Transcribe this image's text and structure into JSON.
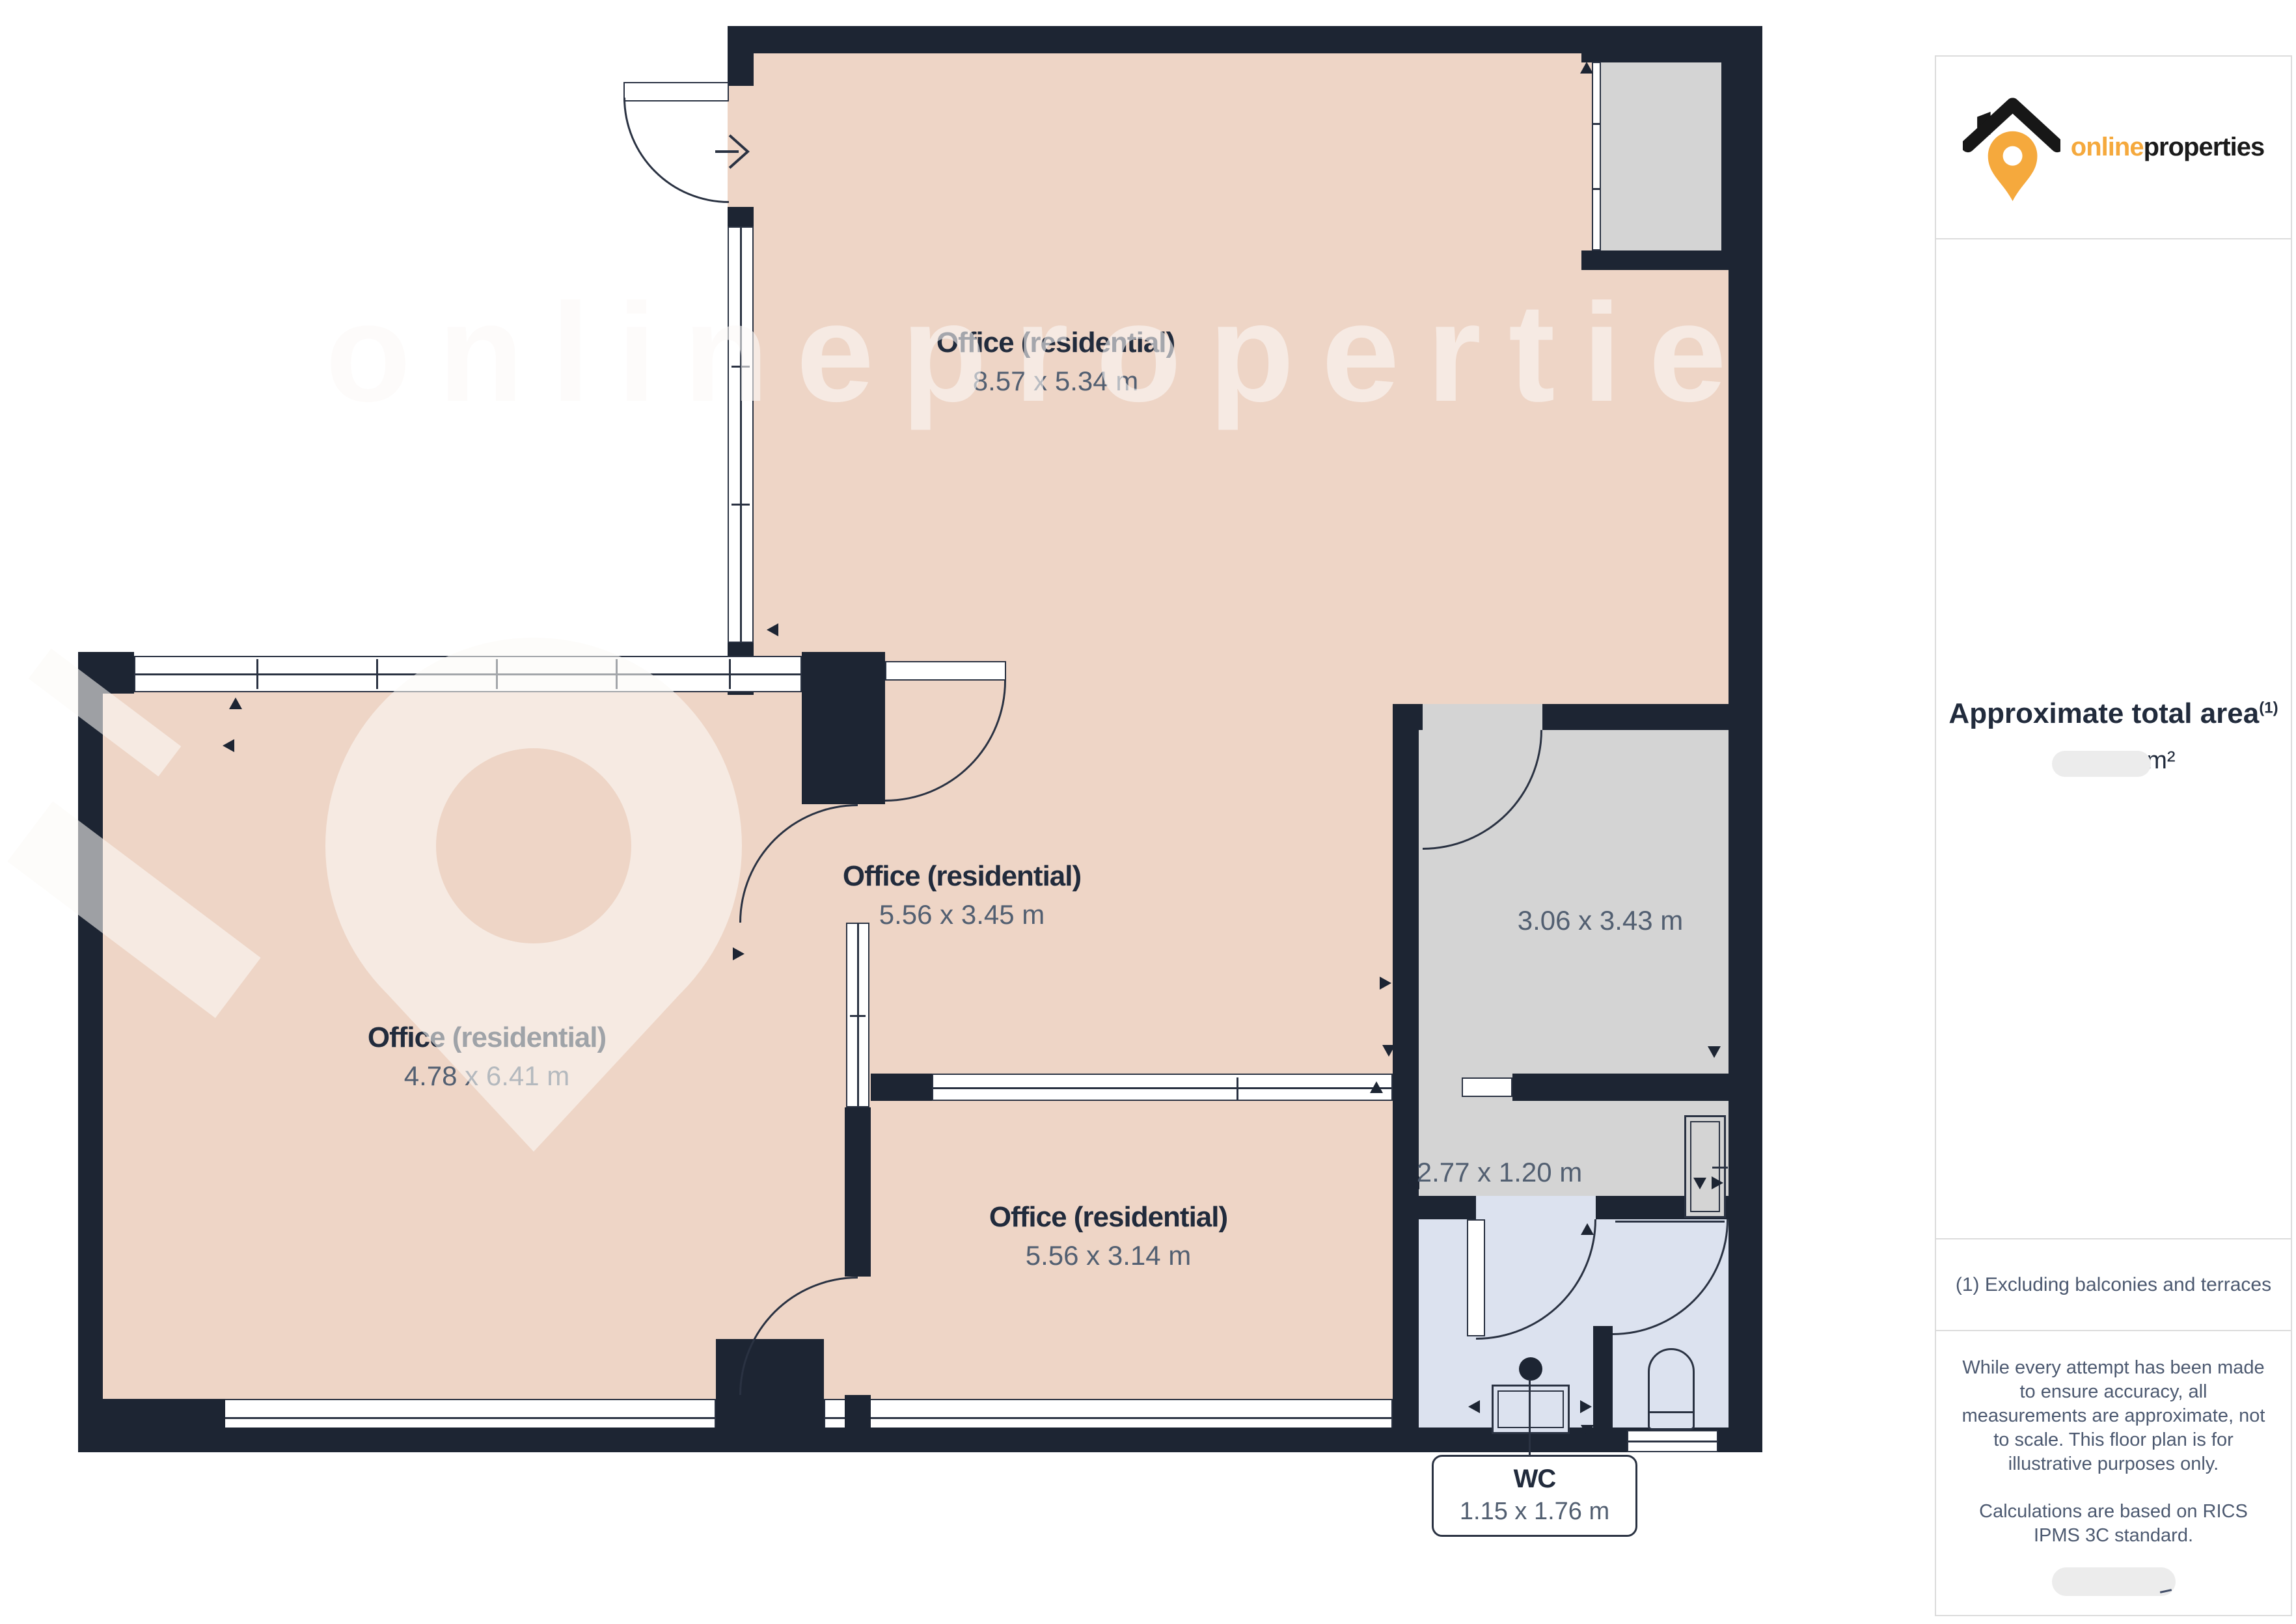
{
  "brand": {
    "prefix": "online",
    "suffix": "properties"
  },
  "watermark": {
    "text": "onlinepropertie"
  },
  "rooms": {
    "office_top": {
      "name": "Office (residential)",
      "dims": "8.57 x 5.34 m"
    },
    "office_middle": {
      "name": "Office (residential)",
      "dims": "5.56 x 3.45 m"
    },
    "office_left": {
      "name": "Office (residential)",
      "dims": "4.78 x 6.41 m"
    },
    "office_bottom": {
      "name": "Office (residential)",
      "dims": "5.56 x 3.14 m"
    },
    "store": {
      "dims": "3.06 x 3.43 m"
    },
    "hall": {
      "dims": "2.77 x 1.20 m"
    },
    "wc": {
      "name": "WC",
      "dims": "1.15 x 1.76 m"
    }
  },
  "sidebar": {
    "area_title": "Approximate total area",
    "area_marker": "(1)",
    "area_unit": "m²",
    "footnote": "(1) Excluding balconies and terraces",
    "disclaimer_1": "While every attempt has been made to ensure accuracy, all measurements are approximate, not to scale. This floor plan is for illustrative purposes only.",
    "disclaimer_2": "Calculations are based on RICS IPMS 3C standard."
  },
  "colors": {
    "wall": "#1d2533",
    "room": "#eed5c6",
    "store": "#d4d4d4",
    "bath": "#dce2ef",
    "accent": "#f5a93d",
    "title": "#212b3c",
    "dims": "#525f71"
  }
}
